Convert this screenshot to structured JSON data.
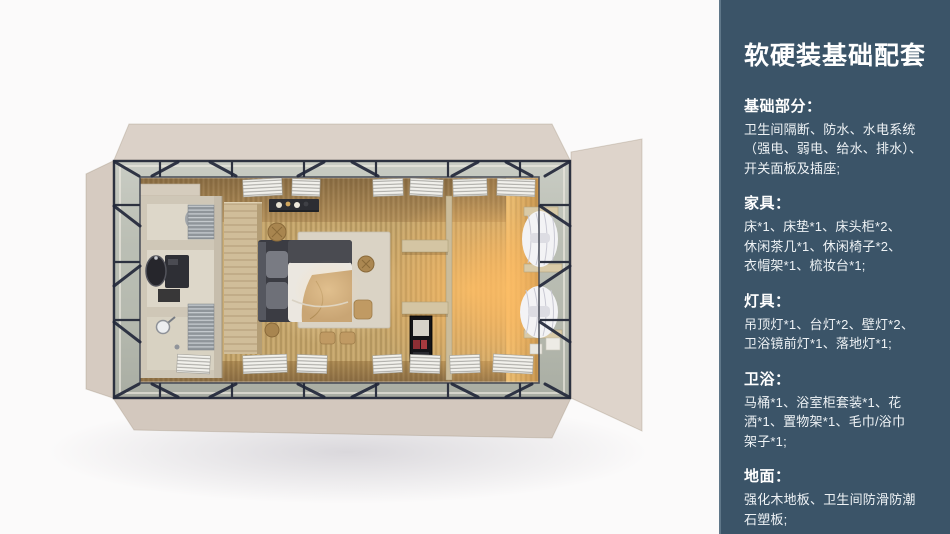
{
  "panel": {
    "title": "软硬装基础配套",
    "sections": [
      {
        "id": "basics",
        "heading": "基础部分：",
        "body": "卫生间隔断、防水、水电系统\n（强电、弱电、给水、排水）、\n开关面板及插座;"
      },
      {
        "id": "furniture",
        "heading": "家具：",
        "body": "床*1、床垫*1、床头柜*2、\n休闲茶几*1、休闲椅子*2、\n衣帽架*1、梳妆台*1;"
      },
      {
        "id": "lighting",
        "heading": "灯具：",
        "body": "吊顶灯*1、台灯*2、壁灯*2、\n卫浴镜前灯*1、落地灯*1;"
      },
      {
        "id": "bath",
        "heading": "卫浴：",
        "body": "马桶*1、浴室柜套装*1、花\n洒*1、置物架*1、毛巾/浴巾\n架子*1;"
      },
      {
        "id": "floor",
        "heading": "地面：",
        "body": "强化木地板、卫生间防滑防潮\n石塑板;"
      }
    ]
  },
  "colors": {
    "panel_bg": "#3b5468",
    "panel_edge": "#5f7789",
    "panel_text": "#ffffff",
    "canvas_bg": "#fbfafa",
    "shell_beige": "#d9cfc6",
    "frame_dark": "#2d3240",
    "band_gray_green": "#b7bbb0",
    "wood_floor": "#c6a76d",
    "warm_glow": "#ffb95f"
  }
}
